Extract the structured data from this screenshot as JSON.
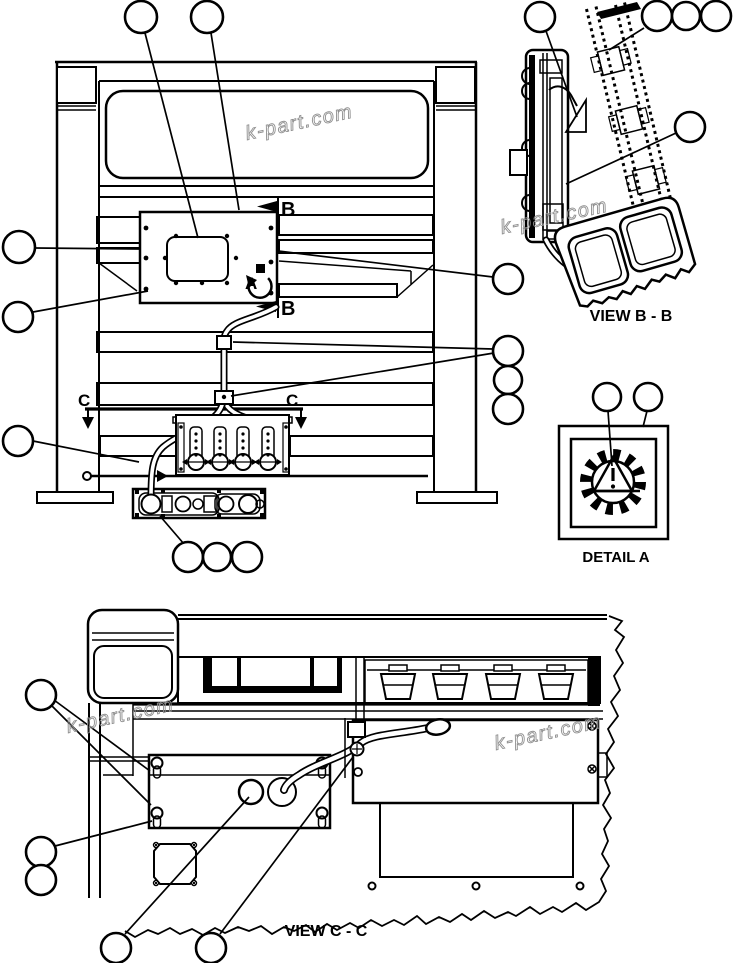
{
  "page": {
    "background": "#ffffff",
    "line_color": "#000000",
    "watermark": {
      "text": "k-part.com",
      "color": "#8f8f8f"
    }
  },
  "labels": {
    "section_b": "B",
    "section_c": "C",
    "detail_marker_a": "A",
    "view_bb_title": "VIEW B - B",
    "detail_a_title": "DETAIL A",
    "view_cc_title": "VIEW C - C"
  },
  "callouts": [
    {
      "group": "main-top",
      "cx": 141,
      "cy": 17,
      "r": 16
    },
    {
      "group": "main-top",
      "cx": 207,
      "cy": 17,
      "r": 16
    },
    {
      "group": "main-left",
      "cx": 19,
      "cy": 247,
      "r": 16
    },
    {
      "group": "main-left",
      "cx": 18,
      "cy": 317,
      "r": 15
    },
    {
      "group": "main-left",
      "cx": 18,
      "cy": 441,
      "r": 15
    },
    {
      "group": "main-right",
      "cx": 508,
      "cy": 279,
      "r": 15
    },
    {
      "group": "main-right",
      "cx": 508,
      "cy": 351,
      "r": 15
    },
    {
      "group": "main-right",
      "cx": 508,
      "cy": 380,
      "r": 14
    },
    {
      "group": "main-right",
      "cx": 508,
      "cy": 409,
      "r": 15
    },
    {
      "group": "main-bottom",
      "cx": 188,
      "cy": 557,
      "r": 15
    },
    {
      "group": "main-bottom",
      "cx": 217,
      "cy": 557,
      "r": 14
    },
    {
      "group": "main-bottom",
      "cx": 247,
      "cy": 557,
      "r": 15
    },
    {
      "group": "view-bb",
      "cx": 540,
      "cy": 17,
      "r": 15
    },
    {
      "group": "view-bb",
      "cx": 657,
      "cy": 16,
      "r": 15
    },
    {
      "group": "view-bb",
      "cx": 686,
      "cy": 16,
      "r": 14
    },
    {
      "group": "view-bb",
      "cx": 716,
      "cy": 16,
      "r": 15
    },
    {
      "group": "view-bb",
      "cx": 690,
      "cy": 127,
      "r": 15
    },
    {
      "group": "detail-a",
      "cx": 607,
      "cy": 397,
      "r": 14
    },
    {
      "group": "detail-a",
      "cx": 648,
      "cy": 397,
      "r": 14
    },
    {
      "group": "view-cc",
      "cx": 41,
      "cy": 695,
      "r": 15
    },
    {
      "group": "view-cc",
      "cx": 41,
      "cy": 852,
      "r": 15
    },
    {
      "group": "view-cc",
      "cx": 41,
      "cy": 880,
      "r": 15
    },
    {
      "group": "view-cc",
      "cx": 116,
      "cy": 948,
      "r": 15
    },
    {
      "group": "view-cc",
      "cx": 211,
      "cy": 948,
      "r": 15
    }
  ]
}
